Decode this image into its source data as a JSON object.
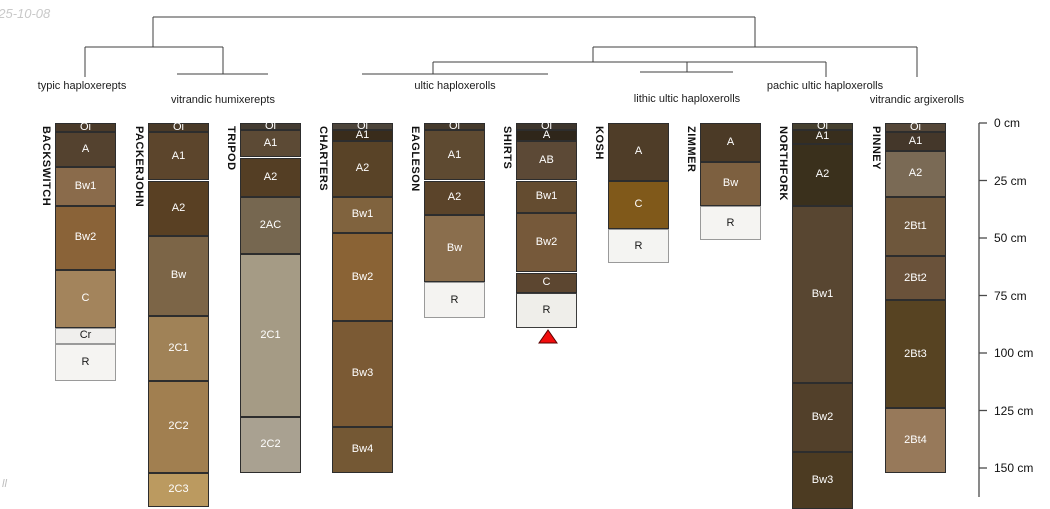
{
  "page": {
    "timestamp_fragment": "025-10-08",
    "watermark_fragment": "ll",
    "background": "#ffffff"
  },
  "chart_data": {
    "type": "soil-profile-dendrogram",
    "title": "",
    "depth_axis": {
      "unit": "cm",
      "axis_x": 979,
      "y_at_0cm": 123,
      "px_per_cm": 2.3,
      "axis_bottom_y": 497,
      "ticks_cm": [
        0,
        25,
        50,
        75,
        100,
        125,
        150
      ],
      "tick_labels": [
        "0 cm",
        "25 cm",
        "50 cm",
        "75 cm",
        "100 cm",
        "125 cm",
        "150 cm"
      ],
      "line_color": "#4a4a4a"
    },
    "dendrogram": {
      "line_color": "#3f3f3f",
      "segments": [
        [
          153,
          17,
          755,
          17
        ],
        [
          153,
          17,
          153,
          47
        ],
        [
          85,
          47,
          223,
          47
        ],
        [
          85,
          47,
          85,
          77
        ],
        [
          223,
          47,
          223,
          74
        ],
        [
          177,
          74,
          268,
          74
        ],
        [
          755,
          17,
          755,
          47
        ],
        [
          593,
          47,
          917,
          47
        ],
        [
          917,
          47,
          917,
          77
        ],
        [
          593,
          47,
          593,
          62
        ],
        [
          433,
          62,
          826,
          62
        ],
        [
          433,
          62,
          433,
          74
        ],
        [
          362,
          74,
          548,
          74
        ],
        [
          687,
          62,
          687,
          72
        ],
        [
          640,
          72,
          733,
          72
        ],
        [
          826,
          62,
          826,
          77
        ]
      ]
    },
    "groups": [
      {
        "label": "typic haploxerepts",
        "cx": 82,
        "top": 80,
        "members": [
          "BACKSWITCH"
        ]
      },
      {
        "label": "vitrandic humixerepts",
        "cx": 223,
        "top": 94,
        "members": [
          "PACKERJOHN",
          "TRIPOD"
        ]
      },
      {
        "label": "ultic haploxerolls",
        "cx": 455,
        "top": 80,
        "members": [
          "CHARTERS",
          "EAGLESON",
          "SHIRTS"
        ]
      },
      {
        "label": "lithic ultic haploxerolls",
        "cx": 687,
        "top": 93,
        "members": [
          "KOSH",
          "ZIMMER"
        ]
      },
      {
        "label": "pachic ultic haploxerolls",
        "cx": 825,
        "top": 80,
        "members": [
          "NORTHFORK"
        ]
      },
      {
        "label": "vitrandic argixerolls",
        "cx": 917,
        "top": 94,
        "members": [
          "PINNEY"
        ]
      }
    ],
    "marker": {
      "shape": "triangle-up",
      "profile": "SHIRTS",
      "cx": 548,
      "top_y": 330,
      "bottom_y": 343,
      "half_width": 9,
      "fill": "#f20d0d",
      "stroke": "#5a0000"
    },
    "column_width": 61,
    "profiles": [
      {
        "name": "BACKSWITCH",
        "x": 55,
        "horizons": [
          {
            "label": "Oi",
            "top_cm": 0,
            "bottom_cm": 4,
            "color": "#4a3a29",
            "text": "#ffffff"
          },
          {
            "label": "A",
            "top_cm": 4,
            "bottom_cm": 19,
            "color": "#54422f",
            "text": "#ffffff"
          },
          {
            "label": "Bw1",
            "top_cm": 19,
            "bottom_cm": 36,
            "color": "#8a6b4b",
            "text": "#ffffff"
          },
          {
            "label": "Bw2",
            "top_cm": 36,
            "bottom_cm": 64,
            "color": "#8a6338",
            "text": "#ffffff"
          },
          {
            "label": "C",
            "top_cm": 64,
            "bottom_cm": 89,
            "color": "#a3845c",
            "text": "#ffffff"
          },
          {
            "label": "Cr",
            "top_cm": 89,
            "bottom_cm": 96,
            "color": "#f0efed",
            "text": "#1a1a1a",
            "border": "#9a9a9a"
          },
          {
            "label": "R",
            "top_cm": 96,
            "bottom_cm": 112,
            "color": "#f5f4f2",
            "text": "#1a1a1a",
            "border": "#9a9a9a"
          }
        ]
      },
      {
        "name": "PACKERJOHN",
        "x": 148,
        "horizons": [
          {
            "label": "Oi",
            "top_cm": 0,
            "bottom_cm": 4,
            "color": "#4a3a28",
            "text": "#ffffff"
          },
          {
            "label": "A1",
            "top_cm": 4,
            "bottom_cm": 25,
            "color": "#5c452c",
            "text": "#ffffff"
          },
          {
            "label": "A2",
            "top_cm": 25,
            "bottom_cm": 49,
            "color": "#594023",
            "text": "#ffffff"
          },
          {
            "label": "Bw",
            "top_cm": 49,
            "bottom_cm": 84,
            "color": "#7c6547",
            "text": "#ffffff"
          },
          {
            "label": "2C1",
            "top_cm": 84,
            "bottom_cm": 112,
            "color": "#a08257",
            "text": "#ffffff"
          },
          {
            "label": "2C2",
            "top_cm": 112,
            "bottom_cm": 152,
            "color": "#a17f50",
            "text": "#ffffff"
          },
          {
            "label": "2C3",
            "top_cm": 152,
            "bottom_cm": 167,
            "color": "#bb9a60",
            "text": "#ffffff"
          }
        ]
      },
      {
        "name": "TRIPOD",
        "x": 240,
        "horizons": [
          {
            "label": "Oi",
            "top_cm": 0,
            "bottom_cm": 3,
            "color": "#433b31",
            "text": "#ffffff"
          },
          {
            "label": "A1",
            "top_cm": 3,
            "bottom_cm": 15,
            "color": "#5c4a35",
            "text": "#ffffff"
          },
          {
            "label": "A2",
            "top_cm": 15,
            "bottom_cm": 32,
            "color": "#543e24",
            "text": "#ffffff"
          },
          {
            "label": "2AC",
            "top_cm": 32,
            "bottom_cm": 57,
            "color": "#766750",
            "text": "#ffffff"
          },
          {
            "label": "2C1",
            "top_cm": 57,
            "bottom_cm": 128,
            "color": "#a59b85",
            "text": "#ffffff"
          },
          {
            "label": "2C2",
            "top_cm": 128,
            "bottom_cm": 152,
            "color": "#a9a191",
            "text": "#ffffff"
          }
        ]
      },
      {
        "name": "CHARTERS",
        "x": 332,
        "horizons": [
          {
            "label": "Oi",
            "top_cm": 0,
            "bottom_cm": 3,
            "color": "#4c443a",
            "text": "#ffffff"
          },
          {
            "label": "A1",
            "top_cm": 3,
            "bottom_cm": 8,
            "color": "#392c1b",
            "text": "#ffffff"
          },
          {
            "label": "A2",
            "top_cm": 8,
            "bottom_cm": 32,
            "color": "#594327",
            "text": "#ffffff"
          },
          {
            "label": "Bw1",
            "top_cm": 32,
            "bottom_cm": 48,
            "color": "#80633e",
            "text": "#ffffff"
          },
          {
            "label": "Bw2",
            "top_cm": 48,
            "bottom_cm": 86,
            "color": "#8a6335",
            "text": "#ffffff"
          },
          {
            "label": "Bw3",
            "top_cm": 86,
            "bottom_cm": 132,
            "color": "#7b5a34",
            "text": "#ffffff"
          },
          {
            "label": "Bw4",
            "top_cm": 132,
            "bottom_cm": 152,
            "color": "#745834",
            "text": "#ffffff"
          }
        ]
      },
      {
        "name": "EAGLESON",
        "x": 424,
        "horizons": [
          {
            "label": "Oi",
            "top_cm": 0,
            "bottom_cm": 3,
            "color": "#453a2c",
            "text": "#ffffff"
          },
          {
            "label": "A1",
            "top_cm": 3,
            "bottom_cm": 25,
            "color": "#5e4a31",
            "text": "#ffffff"
          },
          {
            "label": "A2",
            "top_cm": 25,
            "bottom_cm": 40,
            "color": "#5b442a",
            "text": "#ffffff"
          },
          {
            "label": "Bw",
            "top_cm": 40,
            "bottom_cm": 69,
            "color": "#8a6e4d",
            "text": "#ffffff"
          },
          {
            "label": "R",
            "top_cm": 69,
            "bottom_cm": 85,
            "color": "#f4f3f1",
            "text": "#1a1a1a",
            "border": "#9a9a9a"
          }
        ]
      },
      {
        "name": "SHIRTS",
        "x": 516,
        "horizons": [
          {
            "label": "Oi",
            "top_cm": 0,
            "bottom_cm": 3,
            "color": "#3d352c",
            "text": "#ffffff"
          },
          {
            "label": "A",
            "top_cm": 3,
            "bottom_cm": 8,
            "color": "#2f261a",
            "text": "#ffffff"
          },
          {
            "label": "AB",
            "top_cm": 8,
            "bottom_cm": 25,
            "color": "#5c4936",
            "text": "#ffffff"
          },
          {
            "label": "Bw1",
            "top_cm": 25,
            "bottom_cm": 39,
            "color": "#644c30",
            "text": "#ffffff"
          },
          {
            "label": "Bw2",
            "top_cm": 39,
            "bottom_cm": 65,
            "color": "#76593a",
            "text": "#ffffff"
          },
          {
            "label": "C",
            "top_cm": 65,
            "bottom_cm": 74,
            "color": "#5c4630",
            "text": "#ffffff"
          },
          {
            "label": "R",
            "top_cm": 74,
            "bottom_cm": 89,
            "color": "#efeeea",
            "text": "#1a1a1a",
            "border": "#3c3c3c"
          }
        ]
      },
      {
        "name": "KOSH",
        "x": 608,
        "horizons": [
          {
            "label": "A",
            "top_cm": 0,
            "bottom_cm": 25,
            "color": "#4f3d28",
            "text": "#ffffff"
          },
          {
            "label": "C",
            "top_cm": 25,
            "bottom_cm": 46,
            "color": "#80591a",
            "text": "#ffffff"
          },
          {
            "label": "R",
            "top_cm": 46,
            "bottom_cm": 61,
            "color": "#f4f4f2",
            "text": "#1a1a1a",
            "border": "#9a9a9a"
          }
        ]
      },
      {
        "name": "ZIMMER",
        "x": 700,
        "horizons": [
          {
            "label": "A",
            "top_cm": 0,
            "bottom_cm": 17,
            "color": "#4b3a26",
            "text": "#ffffff"
          },
          {
            "label": "Bw",
            "top_cm": 17,
            "bottom_cm": 36,
            "color": "#7d6040",
            "text": "#ffffff"
          },
          {
            "label": "R",
            "top_cm": 36,
            "bottom_cm": 51,
            "color": "#f5f4f2",
            "text": "#1a1a1a",
            "border": "#9a9a9a"
          }
        ]
      },
      {
        "name": "NORTHFORK",
        "x": 792,
        "horizons": [
          {
            "label": "Oi",
            "top_cm": 0,
            "bottom_cm": 3,
            "color": "#46402f",
            "text": "#ffffff"
          },
          {
            "label": "A1",
            "top_cm": 3,
            "bottom_cm": 9,
            "color": "#382e1d",
            "text": "#ffffff"
          },
          {
            "label": "A2",
            "top_cm": 9,
            "bottom_cm": 36,
            "color": "#3a301c",
            "text": "#ffffff"
          },
          {
            "label": "Bw1",
            "top_cm": 36,
            "bottom_cm": 113,
            "color": "#584631",
            "text": "#ffffff"
          },
          {
            "label": "Bw2",
            "top_cm": 113,
            "bottom_cm": 143,
            "color": "#52402a",
            "text": "#ffffff"
          },
          {
            "label": "Bw3",
            "top_cm": 143,
            "bottom_cm": 168,
            "color": "#4c3b22",
            "text": "#ffffff"
          }
        ]
      },
      {
        "name": "PINNEY",
        "x": 885,
        "horizons": [
          {
            "label": "Oi",
            "top_cm": 0,
            "bottom_cm": 4,
            "color": "#554738",
            "text": "#ffffff"
          },
          {
            "label": "A1",
            "top_cm": 4,
            "bottom_cm": 12,
            "color": "#44372a",
            "text": "#ffffff"
          },
          {
            "label": "A2",
            "top_cm": 12,
            "bottom_cm": 32,
            "color": "#7a6a55",
            "text": "#ffffff"
          },
          {
            "label": "2Bt1",
            "top_cm": 32,
            "bottom_cm": 58,
            "color": "#6e573c",
            "text": "#ffffff"
          },
          {
            "label": "2Bt2",
            "top_cm": 58,
            "bottom_cm": 77,
            "color": "#6a523a",
            "text": "#ffffff"
          },
          {
            "label": "2Bt3",
            "top_cm": 77,
            "bottom_cm": 124,
            "color": "#574322",
            "text": "#ffffff"
          },
          {
            "label": "2Bt4",
            "top_cm": 124,
            "bottom_cm": 152,
            "color": "#97795a",
            "text": "#ffffff"
          }
        ]
      }
    ]
  }
}
